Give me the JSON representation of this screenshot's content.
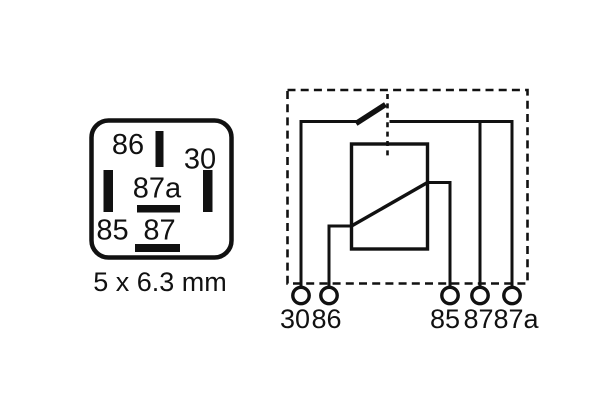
{
  "socket": {
    "pin_86": "86",
    "pin_30": "30",
    "pin_87a": "87a",
    "pin_85": "85",
    "pin_87": "87",
    "caption": "5 x 6.3 mm"
  },
  "schematic": {
    "terminal_30": "30",
    "terminal_86": "86",
    "terminal_85": "85",
    "terminal_87": "87",
    "terminal_87a": "87a"
  },
  "colors": {
    "ink": "#111111",
    "background": "#ffffff"
  }
}
